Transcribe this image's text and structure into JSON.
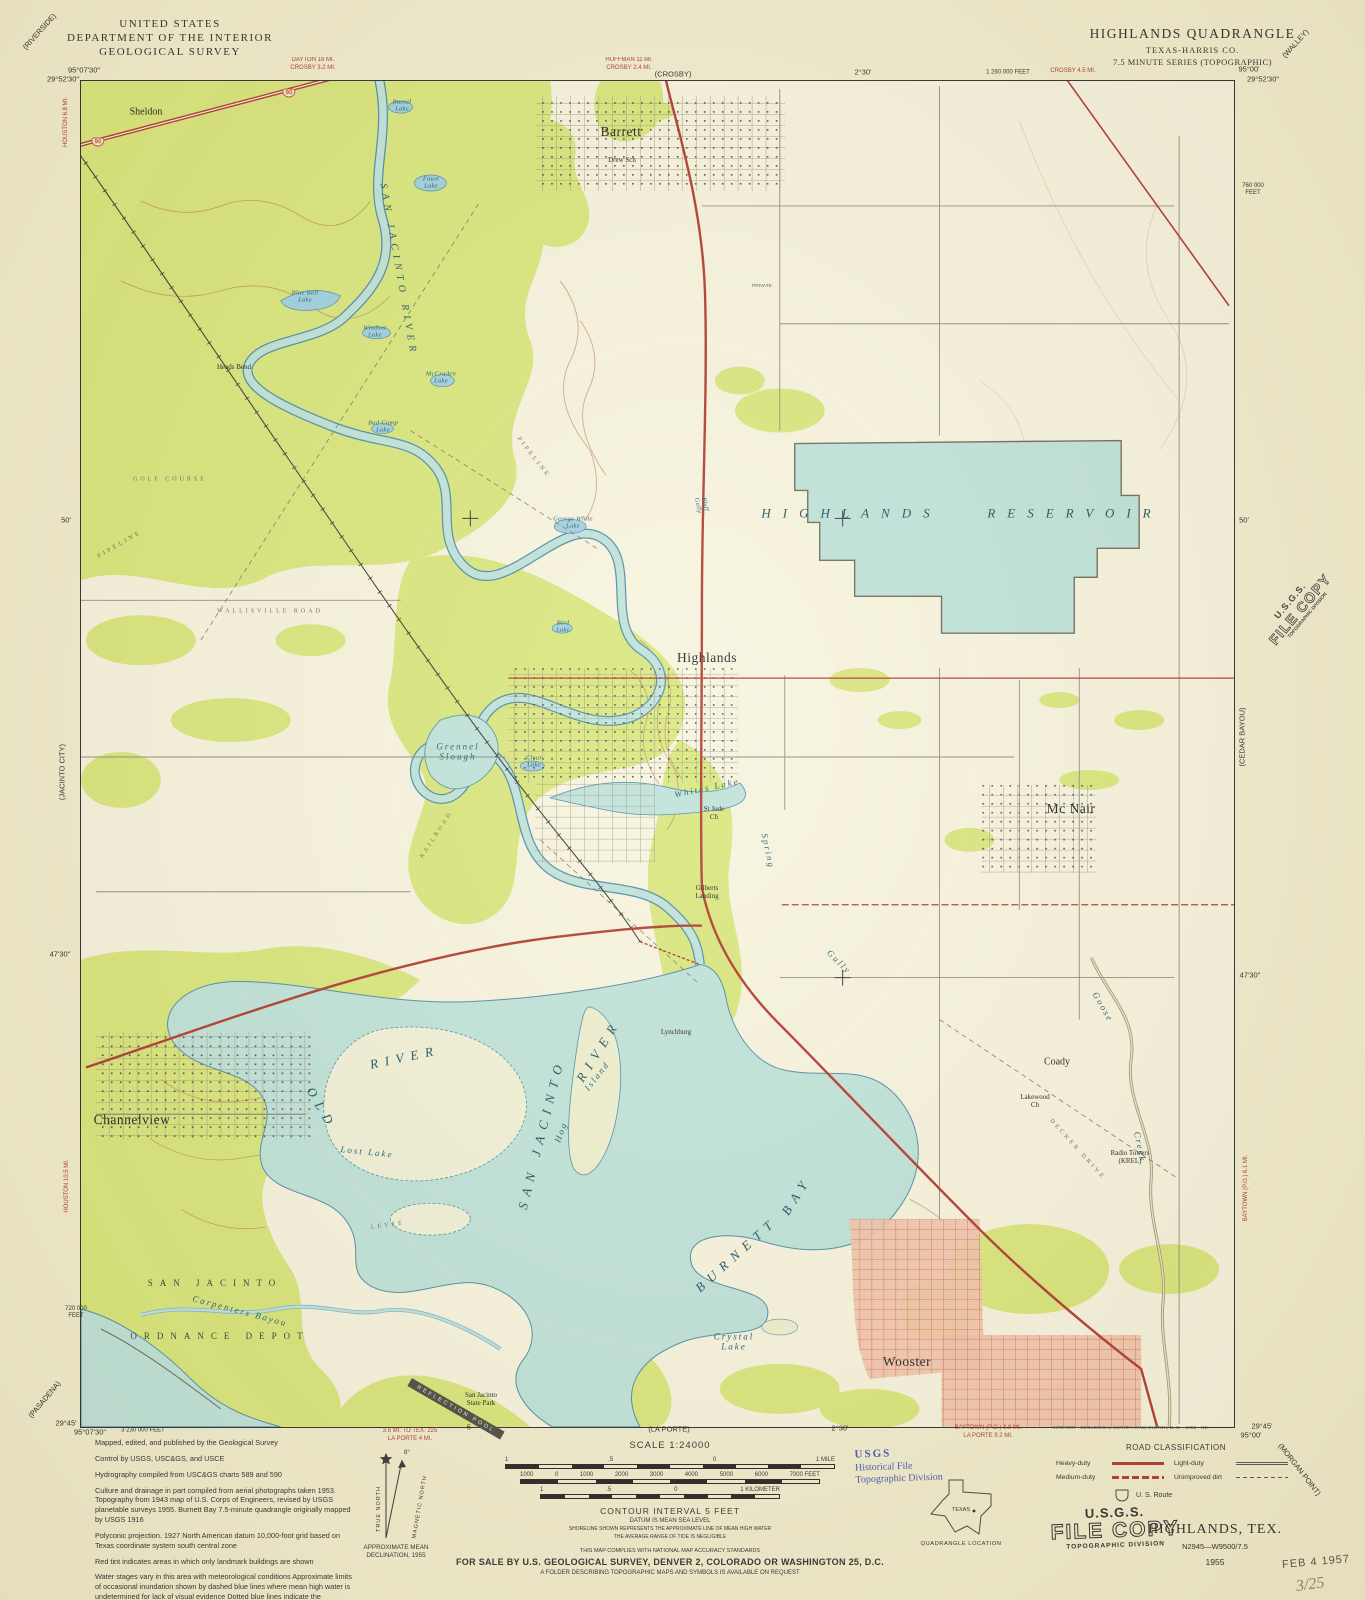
{
  "header": {
    "agency": [
      "UNITED STATES",
      "DEPARTMENT OF THE INTERIOR",
      "GEOLOGICAL SURVEY"
    ],
    "quad_title": "HIGHLANDS QUADRANGLE",
    "quad_state": "TEXAS-HARRIS CO.",
    "quad_series": "7.5 MINUTE SERIES (TOPOGRAPHIC)"
  },
  "colors": {
    "woodland": "#d9e77c",
    "water": "#bfe3da",
    "contour": "#bf8150",
    "road_heavy": "#b0392e",
    "urban_tint": "#f2c3ab",
    "stamp_blue": "#4353b4"
  },
  "footer": {
    "credits": [
      "Mapped, edited, and published by the Geological Survey",
      "Control by USGS, USC&GS, and USCE",
      "Hydrography compiled from USC&GS charts 589 and 590",
      "Culture and drainage in part compiled from aerial photographs taken 1953. Topography from 1943 map of U.S. Corps of Engineers, revised by USGS planetable surveys 1955. Burnett Bay 7.5-minute quadrangle originally mapped by USGS 1916",
      "Polyconic projection.  1927 North American datum 10,000-foot grid based on Texas coordinate system south central zone",
      "Red tint indicates areas in which only landmark buildings are shown",
      "Water stages vary in this area with meteorological conditions Approximate limits of occasional inundation shown by dashed blue lines where mean high water is undetermined for lack of visual evidence Dotted blue lines indicate the approximate limits of low water"
    ],
    "scale": {
      "label": "SCALE 1:24000",
      "mile_labels": [
        "1",
        ".5",
        "0",
        "1 MILE"
      ],
      "feet_labels": [
        "1000",
        "0",
        "1000",
        "2000",
        "3000",
        "4000",
        "5000",
        "6000",
        "7000 FEET"
      ],
      "km_labels": [
        "1",
        ".5",
        "0",
        "1 KILOMETER"
      ]
    },
    "notes": {
      "contour": "CONTOUR INTERVAL 5 FEET",
      "datum": "DATUM IS MEAN SEA LEVEL",
      "shoreline1": "SHORELINE SHOWN REPRESENTS THE APPROXIMATE LINE OF MEAN HIGH WATER",
      "shoreline2": "THE AVERAGE RANGE OF TIDE IS NEGLIGIBLE",
      "compliance": "THIS MAP COMPLIES WITH NATIONAL MAP ACCURACY STANDARDS",
      "sale": "FOR SALE BY U.S. GEOLOGICAL SURVEY, DENVER 2, COLORADO OR WASHINGTON 25, D.C.",
      "folder": "A FOLDER DESCRIBING TOPOGRAPHIC MAPS AND SYMBOLS IS AVAILABLE ON REQUEST"
    },
    "declination": {
      "caption": "APPROXIMATE MEAN DECLINATION, 1955",
      "true_north": "TRUE NORTH",
      "magnetic_north": "MAGNETIC NORTH",
      "angle": "8°"
    },
    "road_classification": {
      "title": "ROAD CLASSIFICATION",
      "heavy": "Heavy-duty",
      "medium": "Medium-duty",
      "light": "Light-duty",
      "unimproved": "Unimproved dirt",
      "us_route": "U. S. Route"
    },
    "quad_location": {
      "state": "TEXAS",
      "caption": "QUADRANGLE LOCATION"
    },
    "map_id": {
      "name": "HIGHLANDS, TEX.",
      "code": "N2945—W9500/7.5",
      "year": "1955"
    },
    "stamps": {
      "blue": [
        "USGS",
        "Historical File",
        "Topographic Division"
      ],
      "file_copy": [
        "U.S.G.S.",
        "FILE COPY",
        "TOPOGRAPHIC DIVISION"
      ],
      "received": "FEB 4 1957",
      "pencil": "3/25"
    }
  },
  "labels": [
    {
      "t": "95°07'30\"",
      "x": 84,
      "y": 71,
      "c": "coord"
    },
    {
      "t": "29°52'30\"",
      "x": 63,
      "y": 80,
      "c": "coord"
    },
    {
      "t": "95°00'",
      "x": 1249,
      "y": 70,
      "c": "coord"
    },
    {
      "t": "29°52'30\"",
      "x": 1263,
      "y": 80,
      "c": "coord"
    },
    {
      "t": "29°45'",
      "x": 66,
      "y": 1424,
      "c": "coord"
    },
    {
      "t": "95°07'30\"",
      "x": 90,
      "y": 1433,
      "c": "coord"
    },
    {
      "t": "3 230 000 FEET",
      "x": 143,
      "y": 1431,
      "c": "coord-sm"
    },
    {
      "t": "29°45'",
      "x": 1262,
      "y": 1427,
      "c": "coord"
    },
    {
      "t": "95°00'",
      "x": 1251,
      "y": 1436,
      "c": "coord"
    },
    {
      "t": "(RIVERSIDE)",
      "x": 40,
      "y": 32,
      "c": "coord",
      "r": -48
    },
    {
      "t": "(WALLEY)",
      "x": 1296,
      "y": 44,
      "c": "coord",
      "r": -48
    },
    {
      "t": "(CROSBY)",
      "x": 673,
      "y": 75,
      "c": "coord"
    },
    {
      "t": "2°30'",
      "x": 863,
      "y": 73,
      "c": "coord"
    },
    {
      "t": "1 260 000 FEET",
      "x": 1008,
      "y": 73,
      "c": "coord-sm"
    },
    {
      "t": "DAYTON 18 MI.\nCROSBY 3.2 MI.",
      "x": 313,
      "y": 65,
      "c": "red-note"
    },
    {
      "t": "HUFFMAN 11 MI.\nCROSBY 2.4 MI.",
      "x": 629,
      "y": 65,
      "c": "red-note"
    },
    {
      "t": "CROSBY 4.5 MI.",
      "x": 1073,
      "y": 72,
      "c": "red-note"
    },
    {
      "t": "760 000\nFEET",
      "x": 1253,
      "y": 190,
      "c": "coord-sm"
    },
    {
      "t": "50'",
      "x": 66,
      "y": 521,
      "c": "coord"
    },
    {
      "t": "50'",
      "x": 1244,
      "y": 521,
      "c": "coord"
    },
    {
      "t": "47'30\"",
      "x": 60,
      "y": 955,
      "c": "coord"
    },
    {
      "t": "47'30\"",
      "x": 1250,
      "y": 976,
      "c": "coord"
    },
    {
      "t": "(JACINTO CITY)",
      "x": 63,
      "y": 772,
      "c": "coord",
      "r": -90
    },
    {
      "t": "(CEDAR BAYOU)",
      "x": 1243,
      "y": 737,
      "c": "coord",
      "r": -90
    },
    {
      "t": "HOUSTON 6.8 MI.",
      "x": 67,
      "y": 122,
      "c": "red-note",
      "r": -90
    },
    {
      "t": "HOUSTON 10.5 MI.",
      "x": 68,
      "y": 1186,
      "c": "red-note",
      "r": -90
    },
    {
      "t": "BAYTOWN (P.O.) 6.1 MI.",
      "x": 1247,
      "y": 1188,
      "c": "red-note",
      "r": -90
    },
    {
      "t": "(PASADENA)",
      "x": 45,
      "y": 1400,
      "c": "coord",
      "r": -50
    },
    {
      "t": "(MORGAN POINT)",
      "x": 1299,
      "y": 1470,
      "c": "coord",
      "r": 52
    },
    {
      "t": "720 000\nFEET",
      "x": 76,
      "y": 1313,
      "c": "coord-sm"
    },
    {
      "t": "(LA PORTE)",
      "x": 669,
      "y": 1430,
      "c": "coord"
    },
    {
      "t": "2°30'",
      "x": 840,
      "y": 1429,
      "c": "coord"
    },
    {
      "t": "5",
      "x": 469,
      "y": 1428,
      "c": "coord"
    },
    {
      "t": "3.6 MI. TO TEX. 225\nLA PORTE 4 MI.",
      "x": 410,
      "y": 1436,
      "c": "red-note"
    },
    {
      "t": "BAYTOWN (P.O.) 3.8 MI.\nLA PORTE 9.2 MI.",
      "x": 988,
      "y": 1433,
      "c": "red-note"
    },
    {
      "t": "INTERIOR—GEOLOGICAL SURVEY, WASHINGTON, D. C.—1956—NE",
      "x": 1130,
      "y": 1429,
      "c": "tiny"
    },
    {
      "t": "Sheldon",
      "x": 146,
      "y": 112,
      "c": "town"
    },
    {
      "t": "Barrett",
      "x": 621,
      "y": 132,
      "c": "city"
    },
    {
      "t": "Drew Sch",
      "x": 622,
      "y": 160,
      "c": "feature"
    },
    {
      "t": "SAN JACINTO RIVER",
      "x": 398,
      "y": 270,
      "c": "river",
      "r": 80
    },
    {
      "t": "Heads Bend",
      "x": 234,
      "y": 367,
      "c": "feature"
    },
    {
      "t": "Bussel\nLake",
      "x": 402,
      "y": 106,
      "c": "water-sm"
    },
    {
      "t": "Faust\nLake",
      "x": 431,
      "y": 183,
      "c": "water-sm"
    },
    {
      "t": "Blue Bell\nLake",
      "x": 305,
      "y": 297,
      "c": "water-sm"
    },
    {
      "t": "Windsor\nLake",
      "x": 375,
      "y": 332,
      "c": "water-sm"
    },
    {
      "t": "McCraden\nLake",
      "x": 441,
      "y": 378,
      "c": "water-sm"
    },
    {
      "t": "Bud Camp\nLake",
      "x": 383,
      "y": 427,
      "c": "water-sm"
    },
    {
      "t": "GOLF COURSE",
      "x": 170,
      "y": 480,
      "c": "spread-sm"
    },
    {
      "t": "George White\nLake",
      "x": 573,
      "y": 523,
      "c": "water-sm"
    },
    {
      "t": "Bird\nLake",
      "x": 563,
      "y": 627,
      "c": "water-sm"
    },
    {
      "t": "WALLISVILLE ROAD",
      "x": 270,
      "y": 612,
      "c": "spread-sm"
    },
    {
      "t": "PIPELINE",
      "x": 120,
      "y": 545,
      "c": "spread-sm",
      "r": -30
    },
    {
      "t": "PIPELINE",
      "x": 533,
      "y": 458,
      "c": "spread-sm",
      "r": 52
    },
    {
      "t": "RAILROAD",
      "x": 437,
      "y": 835,
      "c": "spread-sm",
      "r": -57
    },
    {
      "t": "Bluff\nGully",
      "x": 701,
      "y": 505,
      "c": "water-sm",
      "r": 78
    },
    {
      "t": "PRIVATE",
      "x": 762,
      "y": 287,
      "c": "tiny"
    },
    {
      "t": "Highlands",
      "x": 707,
      "y": 658,
      "c": "city"
    },
    {
      "t": "HIGHLANDS   RESERVOIR",
      "x": 962,
      "y": 514,
      "c": "reservoir"
    },
    {
      "t": "Grennel\nSlough",
      "x": 458,
      "y": 752,
      "c": "water"
    },
    {
      "t": "Clear\nLake",
      "x": 534,
      "y": 762,
      "c": "water-sm"
    },
    {
      "t": "Whites Lake",
      "x": 707,
      "y": 788,
      "c": "water",
      "r": -12
    },
    {
      "t": "St Jude\nCh",
      "x": 714,
      "y": 813,
      "c": "feature"
    },
    {
      "t": "Mc Nair",
      "x": 1071,
      "y": 809,
      "c": "city"
    },
    {
      "t": "Gilberts\nLanding",
      "x": 707,
      "y": 892,
      "c": "feature"
    },
    {
      "t": "Spring",
      "x": 768,
      "y": 851,
      "c": "water",
      "r": 78
    },
    {
      "t": "Gully",
      "x": 839,
      "y": 962,
      "c": "water",
      "r": 45
    },
    {
      "t": "Goose",
      "x": 1103,
      "y": 1007,
      "c": "water",
      "r": 60
    },
    {
      "t": "Creek",
      "x": 1140,
      "y": 1147,
      "c": "water",
      "r": 78
    },
    {
      "t": "Lynchburg",
      "x": 676,
      "y": 1032,
      "c": "feature"
    },
    {
      "t": "OLD",
      "x": 321,
      "y": 1109,
      "c": "water-big",
      "r": 60
    },
    {
      "t": "RIVER",
      "x": 405,
      "y": 1058,
      "c": "water-big",
      "r": -12
    },
    {
      "t": "Lost Lake",
      "x": 367,
      "y": 1152,
      "c": "water",
      "r": 6
    },
    {
      "t": "SAN JACINTO",
      "x": 542,
      "y": 1134,
      "c": "water-big",
      "r": -76
    },
    {
      "t": "RIVER",
      "x": 599,
      "y": 1051,
      "c": "water-big",
      "r": -58
    },
    {
      "t": "Hog",
      "x": 561,
      "y": 1132,
      "c": "water",
      "r": -70
    },
    {
      "t": "Island",
      "x": 597,
      "y": 1076,
      "c": "water",
      "r": -52
    },
    {
      "t": "Channelview",
      "x": 132,
      "y": 1120,
      "c": "city"
    },
    {
      "t": "SAN JACINTO",
      "x": 215,
      "y": 1283,
      "c": "spread"
    },
    {
      "t": "ORDNANCE DEPOT",
      "x": 220,
      "y": 1336,
      "c": "spread"
    },
    {
      "t": "Carpenters Bayou",
      "x": 240,
      "y": 1311,
      "c": "water",
      "r": 15
    },
    {
      "t": "LEVEE",
      "x": 388,
      "y": 1226,
      "c": "spread-sm",
      "r": -8
    },
    {
      "t": "BURNETT",
      "x": 737,
      "y": 1255,
      "c": "water-big",
      "r": -42
    },
    {
      "t": "BAY",
      "x": 797,
      "y": 1196,
      "c": "water-big",
      "r": -58
    },
    {
      "t": "Crystal\nLake",
      "x": 734,
      "y": 1342,
      "c": "water"
    },
    {
      "t": "Wooster",
      "x": 907,
      "y": 1362,
      "c": "city"
    },
    {
      "t": "Coady",
      "x": 1057,
      "y": 1062,
      "c": "town"
    },
    {
      "t": "Lakewood\nCh",
      "x": 1035,
      "y": 1101,
      "c": "feature"
    },
    {
      "t": "Radio Towers\n(KREL)",
      "x": 1130,
      "y": 1157,
      "c": "feature"
    },
    {
      "t": "San Jacinto\nState Park",
      "x": 481,
      "y": 1399,
      "c": "feature"
    },
    {
      "t": "REFLECTION POOL",
      "x": 456,
      "y": 1409,
      "c": "pool",
      "r": 30
    },
    {
      "t": "DECKER DRIVE",
      "x": 1077,
      "y": 1150,
      "c": "spread-sm",
      "r": 48
    },
    {
      "t": "90",
      "x": 289,
      "y": 93,
      "c": "shield",
      "n": "us-route-90-shield"
    },
    {
      "t": "90",
      "x": 98,
      "y": 142,
      "c": "shield",
      "n": "us-route-90-shield"
    }
  ]
}
